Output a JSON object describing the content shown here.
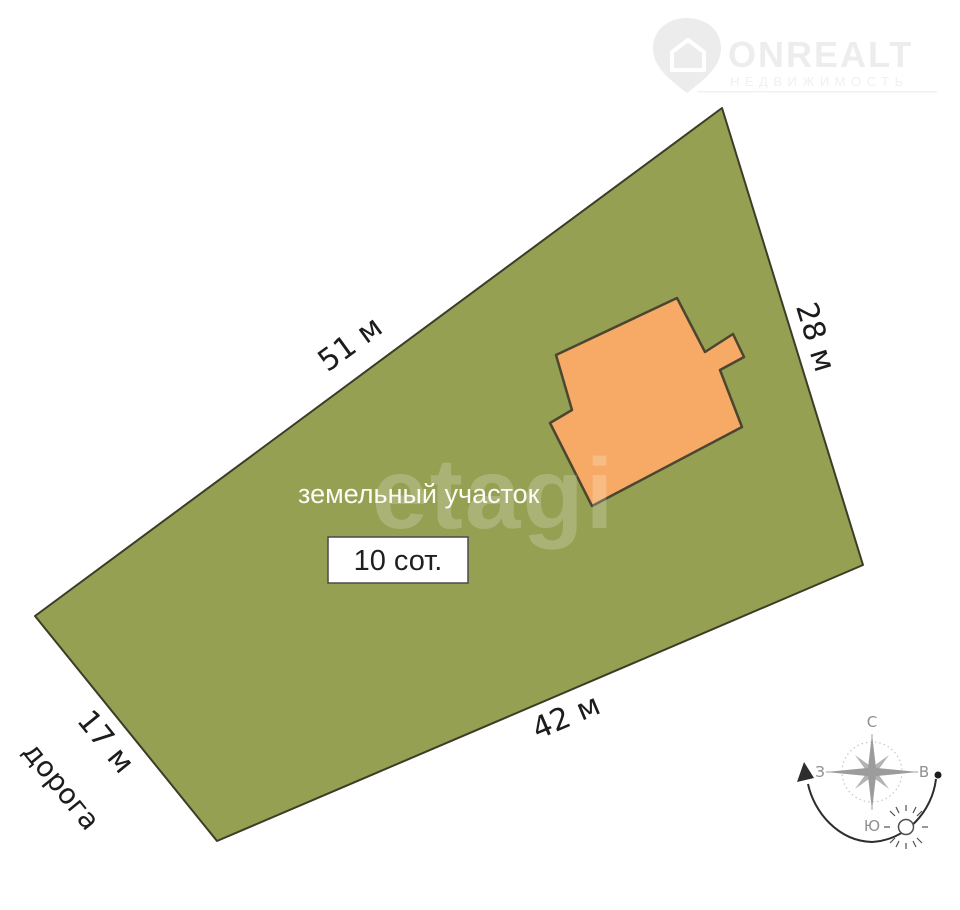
{
  "brand": {
    "logo_title": "ONREALT",
    "logo_subtitle": "НЕДВИЖИМОСТЬ",
    "watermark": "etagi"
  },
  "plot": {
    "title": "земельный участок",
    "area": "10 сот.",
    "dimensions": {
      "top_left_edge": "51 м",
      "right_edge": "28 м",
      "bottom_edge": "42 м",
      "left_edge": "17 м"
    },
    "road": "дорога",
    "colors": {
      "land": "#95a053",
      "land_outline": "#3d3c26",
      "building": "#f6aa65",
      "building_outline": "#4c4631"
    }
  },
  "compass": {
    "north": "С",
    "south": "Ю",
    "west": "З",
    "east": "В"
  }
}
